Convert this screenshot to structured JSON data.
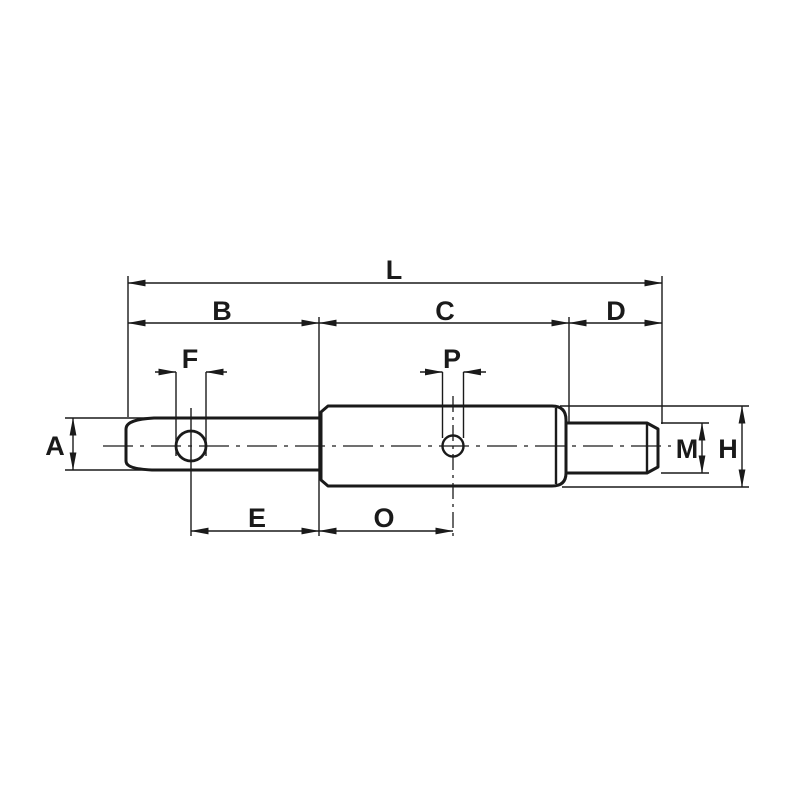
{
  "diagram": {
    "kind": "technical-dimension-drawing",
    "labels": {
      "L": "L",
      "B": "B",
      "C": "C",
      "D": "D",
      "F": "F",
      "P": "P",
      "A": "A",
      "E": "E",
      "O": "O",
      "M": "M",
      "H": "H"
    },
    "colors": {
      "line": "#1a1a1a",
      "background": "#ffffff"
    }
  }
}
